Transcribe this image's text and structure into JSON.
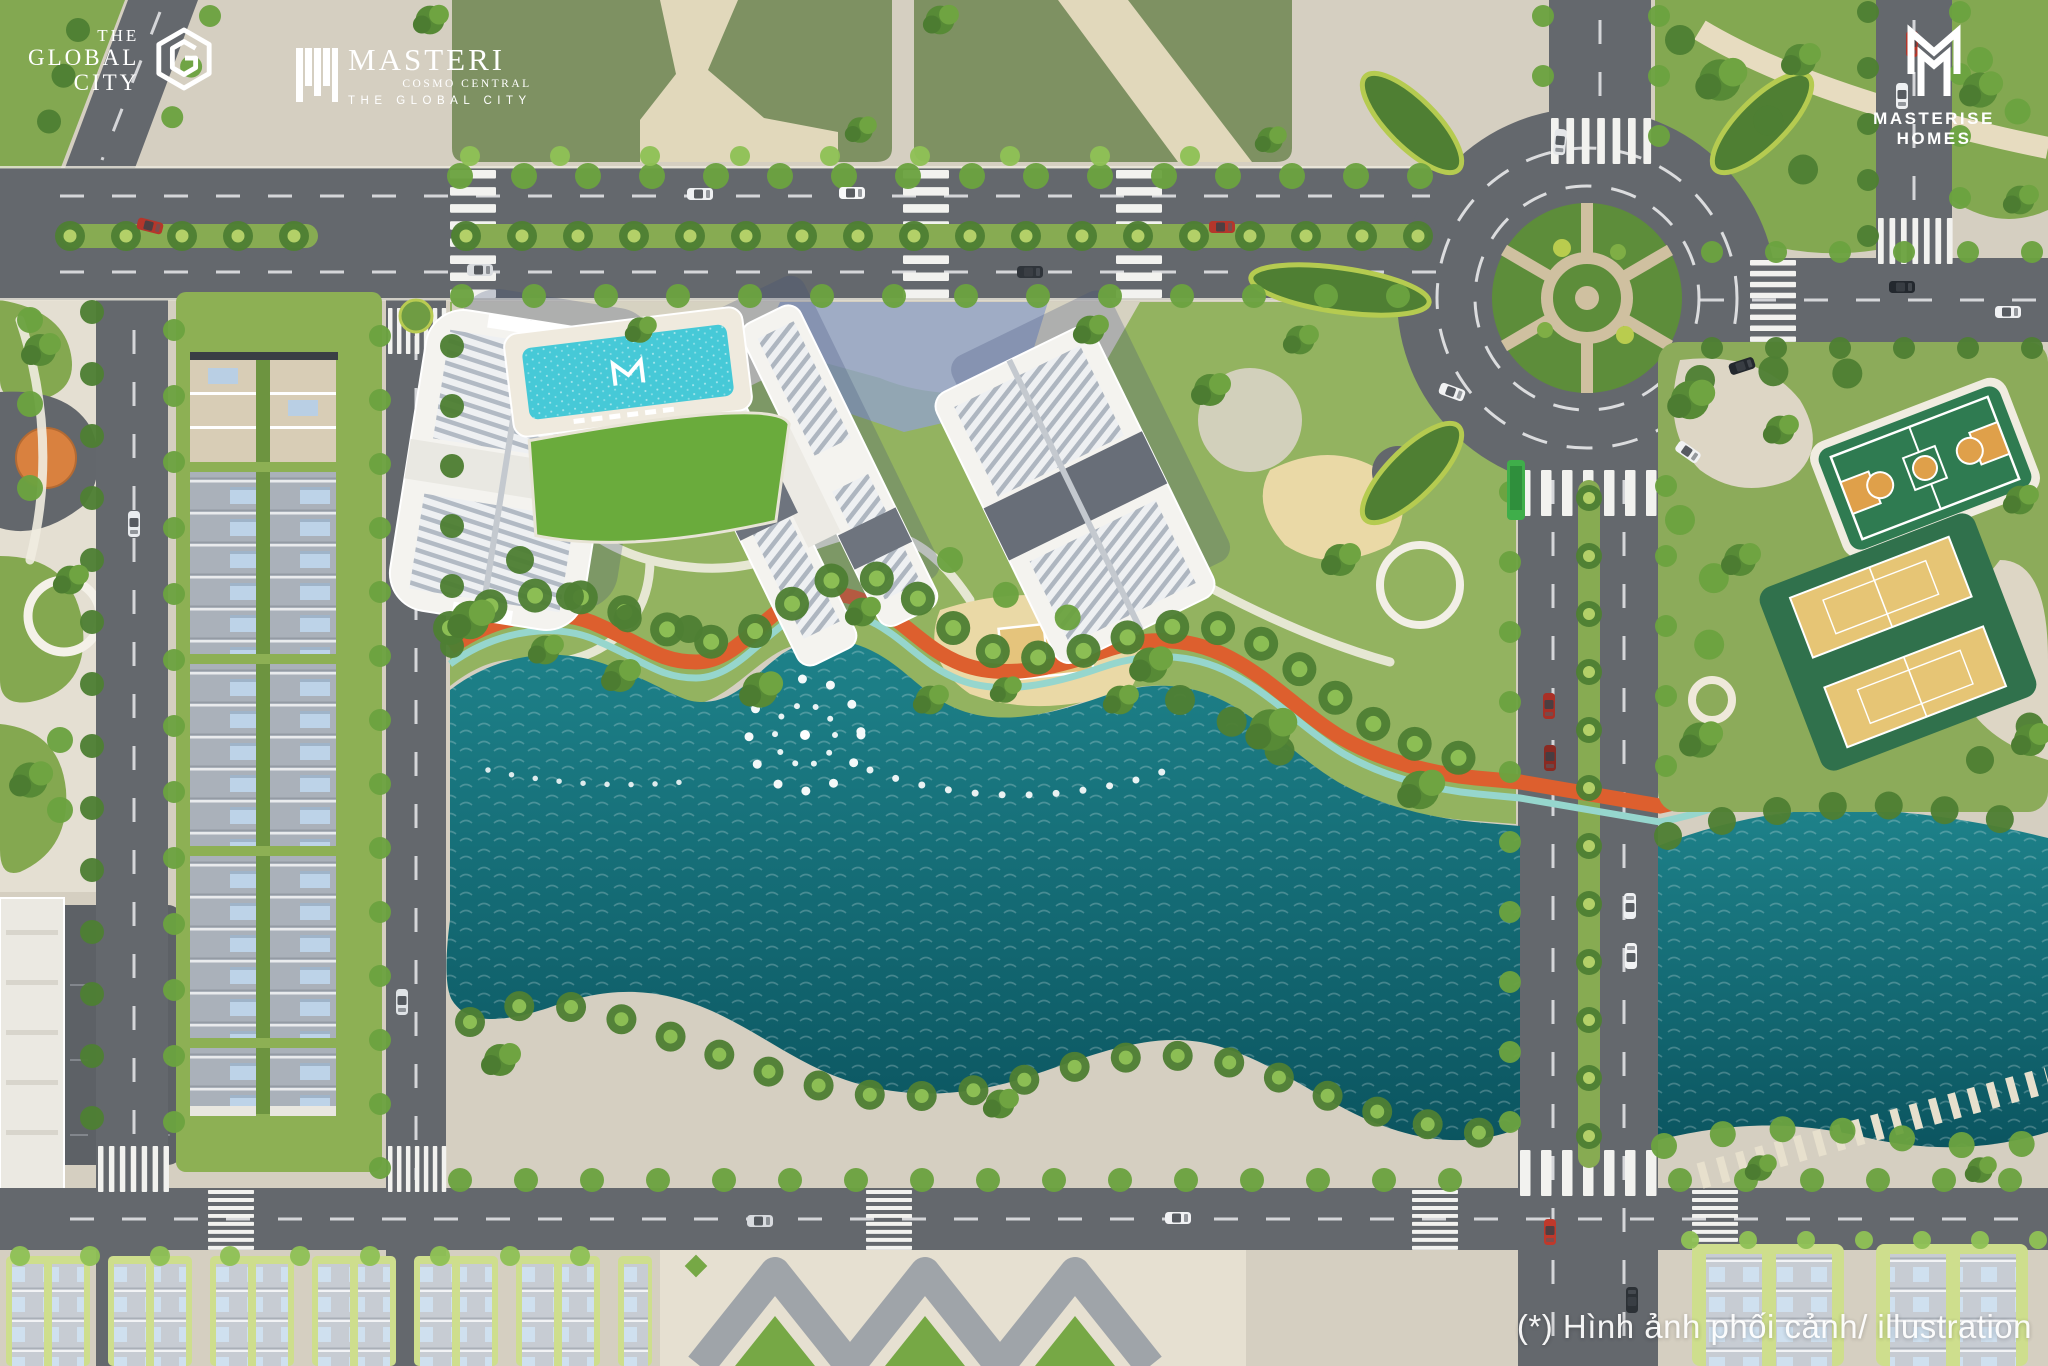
{
  "branding": {
    "the_global_city": {
      "line1": "THE",
      "line2": "GLOBAL",
      "line3": "CITY",
      "icon": "hexagon-g-logo"
    },
    "masteri": {
      "name": "MASTERI",
      "subtitle": "COSMO CENTRAL",
      "tagline": "THE GLOBAL CITY",
      "icon": "masteri-m-logo"
    },
    "masterise_homes": {
      "name": "MASTERISE HOMES",
      "icon": "masterise-m-monogram"
    }
  },
  "footer": {
    "disclaimer": "(*) Hình ảnh phối cảnh/ illustration"
  },
  "scene": {
    "description": "aerial-render-of-residential-masterplan",
    "features": [
      "main-boulevard",
      "roundabout",
      "central-apartment-towers",
      "swimming-pool",
      "event-lawn",
      "central-lake",
      "lake-fountain",
      "orange-jogging-path",
      "teal-cycle-path",
      "townhouse-rows",
      "basketball-court",
      "tennis-courts",
      "sports-park",
      "beach-volleyball-court",
      "playground",
      "bottom-plaza",
      "villa-blocks",
      "street-trees",
      "vehicles",
      "shuttle-bus"
    ],
    "counts": {
      "apartment_towers": 3,
      "tennis_courts": 2,
      "basketball_courts": 1,
      "roundabouts": 1
    },
    "colors": {
      "road": "#63676c",
      "pavement": "#d5cfc1",
      "grass": "#8fb05a",
      "olive_lawn": "#7e9162",
      "lake": "#14707a",
      "pool": "#46c9d7",
      "jogging_path": "#dd5f2e",
      "cycle_path": "#96d6cd",
      "rooftop": "#f3f2ee",
      "tennis_court": "#e4c271",
      "basketball_court": "#2f7b51",
      "townhouse_roof": "#abb2ba",
      "shuttle_bus": "#3fae4a"
    }
  }
}
